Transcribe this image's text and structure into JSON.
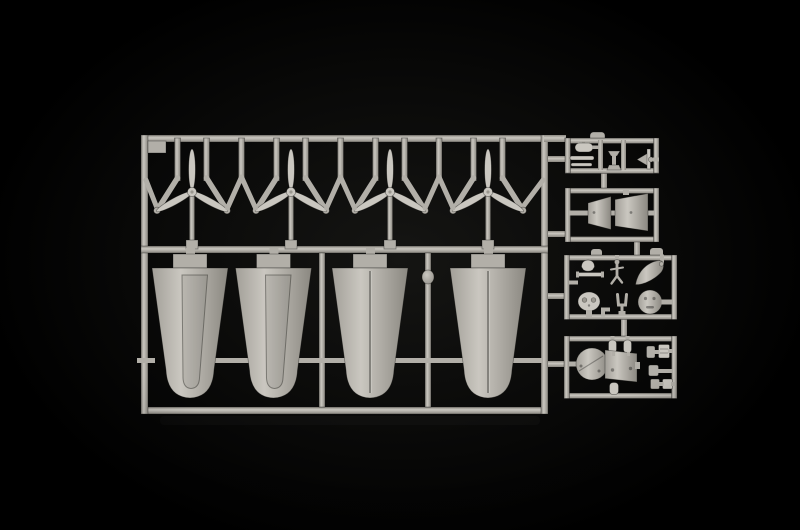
{
  "scene": {
    "kind": "photograph",
    "description": "Light grey injection-moulded plastic model kit sprue (parts tree) photographed on a black background"
  },
  "palette": {
    "background_center": "#151513",
    "background_edge": "#000000",
    "plastic_base": "#b2afa8",
    "plastic_light": "#cac7c0",
    "plastic_dark": "#8b8881",
    "plastic_deep": "#716e68",
    "detail_shade": "#9a978f",
    "part_edge": "#a29f98"
  },
  "sprue": {
    "label": "model-kit-parts-tree",
    "sections": [
      {
        "id": "propeller-row",
        "description": "four three-blade propellers",
        "count": 4
      },
      {
        "id": "float-row",
        "description": "four tapered float half shells",
        "count": 4
      },
      {
        "id": "detail-frame-1",
        "description": "small fittings, two rods and a tiny spinner"
      },
      {
        "id": "detail-frame-2",
        "description": "two wedge shaped panel halves"
      },
      {
        "id": "detail-frame-3",
        "description": "dome, rod, mast, spinner cone, engine front, fork and cowl ring"
      },
      {
        "id": "detail-frame-4",
        "description": "bulkhead disc, instrument panel and small cylinders"
      }
    ]
  }
}
